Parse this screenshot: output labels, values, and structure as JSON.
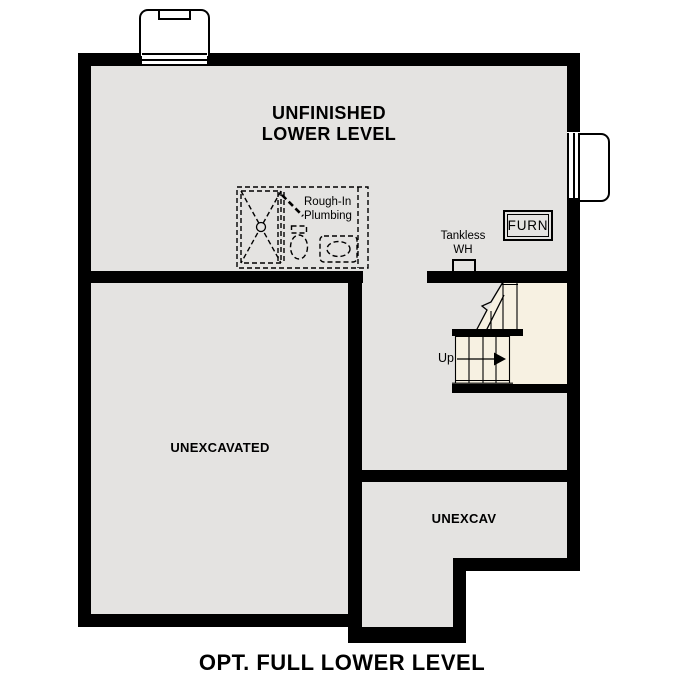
{
  "plan": {
    "title": "OPT. FULL LOWER LEVEL"
  },
  "rooms": {
    "main": {
      "label_line1": "UNFINISHED",
      "label_line2": "LOWER LEVEL"
    },
    "unexcavated": {
      "label": "UNEXCAVATED"
    },
    "unexcav": {
      "label": "UNEXCAV"
    }
  },
  "annotations": {
    "rough_in_plumbing": {
      "line1": "Rough-In",
      "line2": "Plumbing"
    },
    "tankless_water_heater": {
      "line1": "Tankless",
      "line2": "WH"
    },
    "furnace": {
      "label": "FURN"
    },
    "stairs": {
      "direction_label": "Up"
    }
  },
  "colors": {
    "background": "#ffffff",
    "floor": "#e4e3e1",
    "stair_floor": "#f7f1e2",
    "wall": "#000000"
  }
}
